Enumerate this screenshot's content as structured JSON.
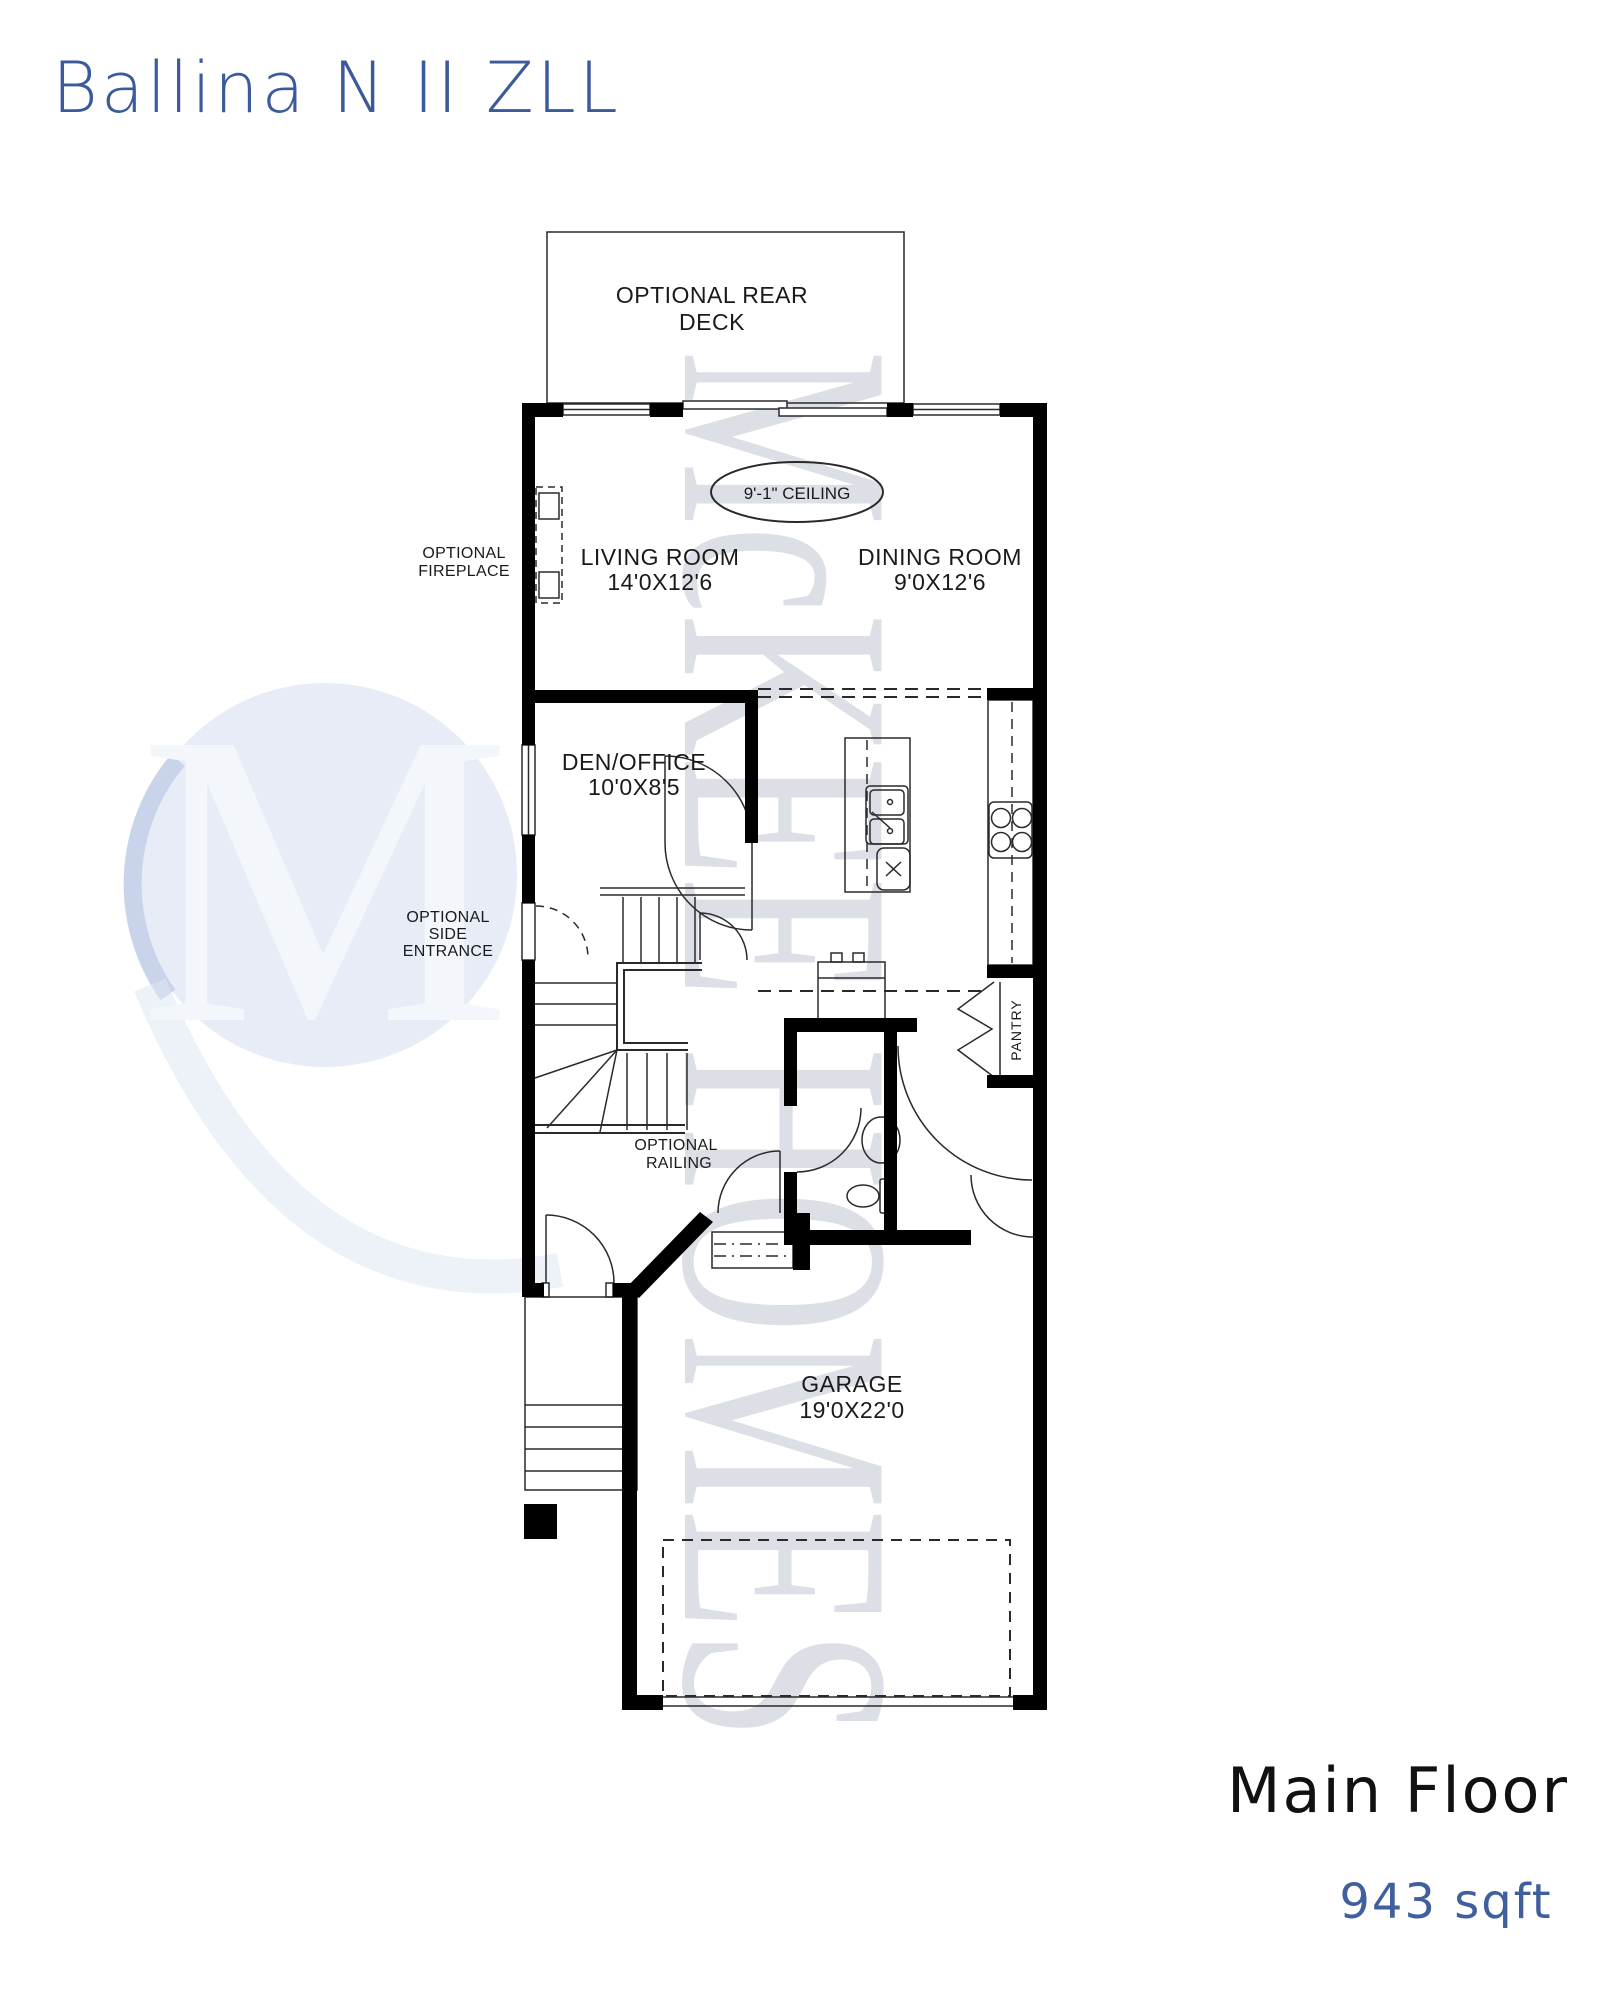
{
  "title": "Ballina N II ZLL",
  "watermark": {
    "logo_letter": "M",
    "brand_text": "McKEE HOMES"
  },
  "plan": {
    "deck_label_line1": "OPTIONAL REAR",
    "deck_label_line2": "DECK",
    "ceiling_note": "9'-1\" CEILING",
    "rooms": {
      "living": {
        "name": "LIVING ROOM",
        "dims": "14'0X12'6"
      },
      "dining": {
        "name": "DINING ROOM",
        "dims": "9'0X12'6"
      },
      "den": {
        "name": "DEN/OFFICE",
        "dims": "10'0X8'5"
      },
      "garage": {
        "name": "GARAGE",
        "dims": "19'0X22'0"
      },
      "pantry": {
        "name": "PANTRY"
      }
    },
    "options": {
      "fireplace_line1": "OPTIONAL",
      "fireplace_line2": "FIREPLACE",
      "side_entrance_line1": "OPTIONAL",
      "side_entrance_line2": "SIDE",
      "side_entrance_line3": "ENTRANCE",
      "railing_line1": "OPTIONAL",
      "railing_line2": "RAILING"
    }
  },
  "footer": {
    "floor_name": "Main Floor",
    "area": "943 sqft"
  },
  "colors": {
    "title_blue": "#3a5a9c",
    "area_blue": "#3f5f9f",
    "ink": "#1a1a1a",
    "wall_black": "#000000",
    "watermark_gray": "#dcdfe5",
    "logo_blue": "#e7ecf6"
  }
}
